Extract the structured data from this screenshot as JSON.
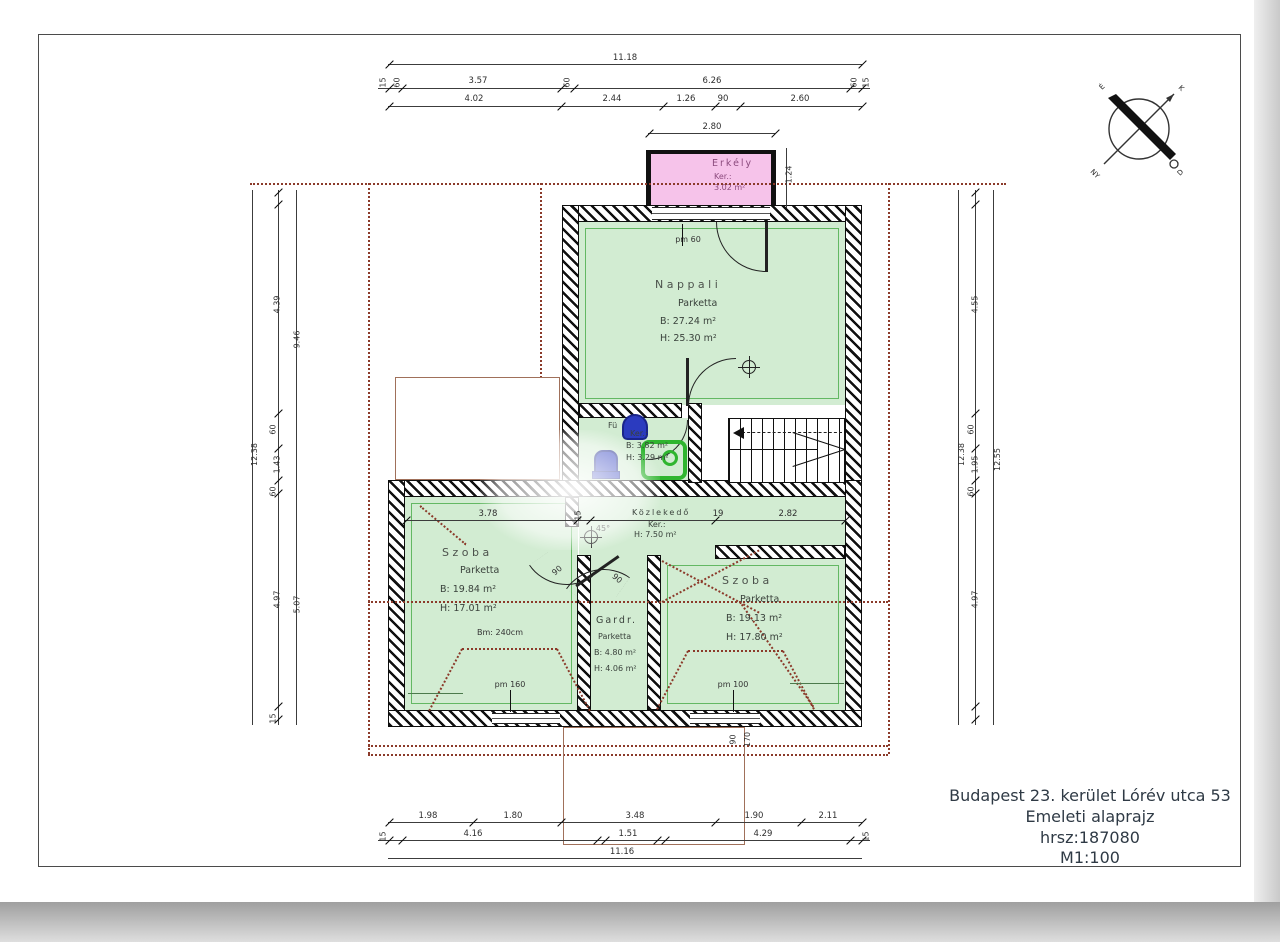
{
  "title_block": {
    "line1": "Budapest 23. kerület Lórév utca 53",
    "line2": "Emeleti alaprajz",
    "line3": "hrsz:187080",
    "line4": "M1:100"
  },
  "compass": {
    "n": "É",
    "e": "K",
    "s": "D",
    "w": "NY"
  },
  "rooms": {
    "erkely": {
      "name": "Erkély",
      "floor": "Ker.:",
      "area": "3.02 m²"
    },
    "nappali": {
      "name": "Nappali",
      "floor": "Parketta",
      "b": "B:  27.24 m²",
      "h": "H:  25.30 m²"
    },
    "furdo": {
      "name": "Fü",
      "floor": "Ker.:",
      "b": "B:  3.82 m²",
      "h": "H:  3.29 m²"
    },
    "kozlekedo": {
      "name": "Közlekedő",
      "floor": "Ker.:",
      "h": "H:  7.50 m²"
    },
    "szoba1": {
      "name": "Szoba",
      "floor": "Parketta",
      "b": "B:  19.84 m²",
      "h": "H:  17.01 m²",
      "ceiling": "Bm: 240cm"
    },
    "gardrob": {
      "name": "Gardr.",
      "floor": "Parketta",
      "b": "B:  4.80 m²",
      "h": "H:  4.06 m²"
    },
    "szoba2": {
      "name": "Szoba",
      "floor": "Parketta",
      "b": "B:  19.13 m²",
      "h": "H:  17.80 m²"
    }
  },
  "markers": {
    "pm60": "pm 60",
    "pm160": "pm 160",
    "pm100": "pm 100",
    "door_a": "90",
    "door_b": "90",
    "angle": "45°",
    "open_w": "90",
    "open_h": "170"
  },
  "dims": {
    "top_overall": "11.18",
    "t2_15l": "15",
    "t2_60l": "60",
    "t2_357": "3.57",
    "t2_60m": "60",
    "t2_626": "6.26",
    "t2_60r": "60",
    "t2_15r": "15",
    "t3_402": "4.02",
    "t3_244": "2.44",
    "t3_126": "1.26",
    "t3_90": "90",
    "t3_260": "2.60",
    "balc_w": "2.80",
    "balc_d": "1.24",
    "b1_198": "1.98",
    "b1_180": "1.80",
    "b1_348": "3.48",
    "b1_190": "1.90",
    "b1_211": "2.11",
    "b2_15l": "15",
    "b2_416": "4.16",
    "b2_151": "1.51",
    "b2_429": "4.29",
    "b2_15r": "15",
    "bottom_overall": "11.16",
    "l_overall": "12.38",
    "l_439": "4.39",
    "l_60a": "60",
    "l_143": "1.43",
    "l_60b": "60",
    "l_497": "4.97",
    "l_15": "15",
    "l_946": "9.46",
    "l_507": "5.07",
    "r_overall": "12.38",
    "r_455": "4.55",
    "r_60a": "60",
    "r_195": "1.95",
    "r_60b": "60",
    "r_497": "4.97",
    "r_1255": "12.55",
    "i_378": "3.78",
    "i_15": "15",
    "i_19": "19",
    "i_282": "2.82"
  },
  "colors": {
    "room_fill": "#d2ecd2",
    "balcony_fill": "#f6c3ea",
    "roof_dashed": "#8b3a2a",
    "fixture_blue": "#2b3bbf",
    "shower_green": "#2fb52f",
    "wall_black": "#101010"
  }
}
